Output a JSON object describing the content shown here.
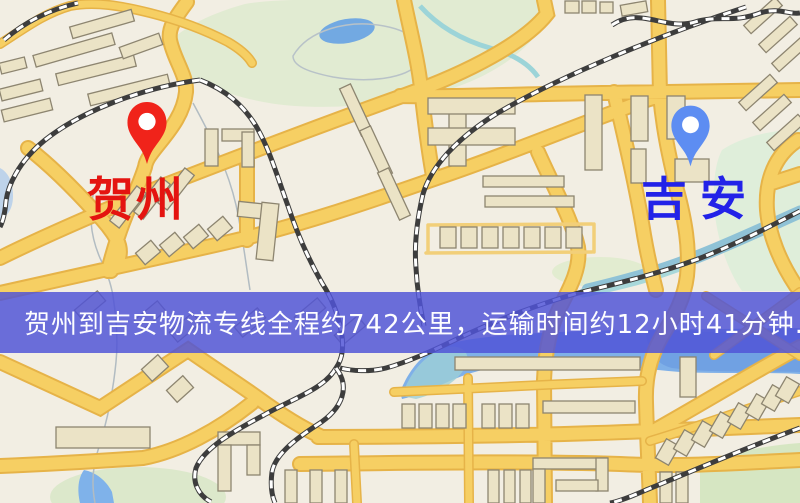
{
  "type": "map-route-graphic",
  "origin": {
    "name": "贺州",
    "pin_icon": "location-pin-icon",
    "pin_color": "#f0231a",
    "label_color": "#e41410"
  },
  "destination": {
    "name": "吉安",
    "pin_icon": "location-pin-icon",
    "pin_color": "#5d8df2",
    "label_color": "#2222e8"
  },
  "banner": {
    "text": "贺州到吉安物流专线全程约742公里，运输时间约12小时41分钟.",
    "background_color": "rgba(80,83,214,0.84)",
    "text_color": "#ffffff"
  },
  "map": {
    "palette": {
      "background": "#f2eee3",
      "road_fill": "#f6cf63",
      "road_casing": "#e6b348",
      "minor_road": "#f2cf79",
      "building_fill": "#ebe3c6",
      "building_stroke": "#8d8570",
      "park_green": "#e1ebd2",
      "water_blue": "#7fb0e8",
      "stream_teal": "#9cd4d8",
      "railway_dark": "#3d3d3d",
      "railway_light": "#ffffff"
    }
  }
}
